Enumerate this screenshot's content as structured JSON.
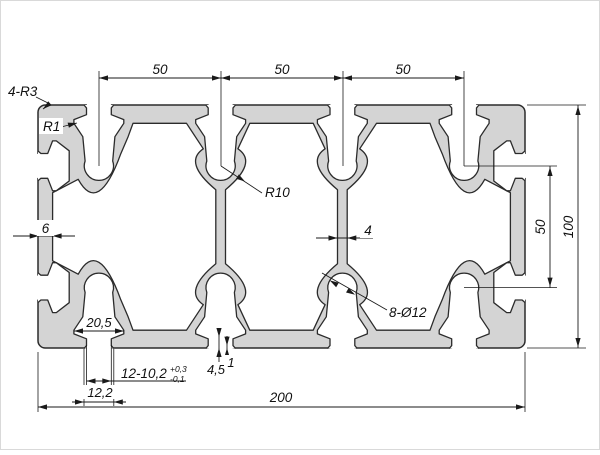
{
  "drawing": {
    "background": "#ffffff",
    "profile_fill": "#d4d4d4",
    "line_color": "#2b2b2b",
    "dim_color": "#1a1a1a",
    "labels": {
      "corner_radius": "4-R3",
      "lip_radius": "R1",
      "pitch_1": "50",
      "pitch_2": "50",
      "pitch_3": "50",
      "bore_radius": "R10",
      "wall_thickness": "6",
      "web_thickness": "4",
      "holes": "8-Ø12",
      "side_pitch": "50",
      "height": "100",
      "chamber_width": "20,5",
      "slot_spec": "12-10,2",
      "slot_tol_upper": "+0,3",
      "slot_tol_lower": "-0,1",
      "mouth_width": "12,2",
      "lip_depth": "4,5",
      "lip_edge": "1",
      "width": "200"
    }
  }
}
